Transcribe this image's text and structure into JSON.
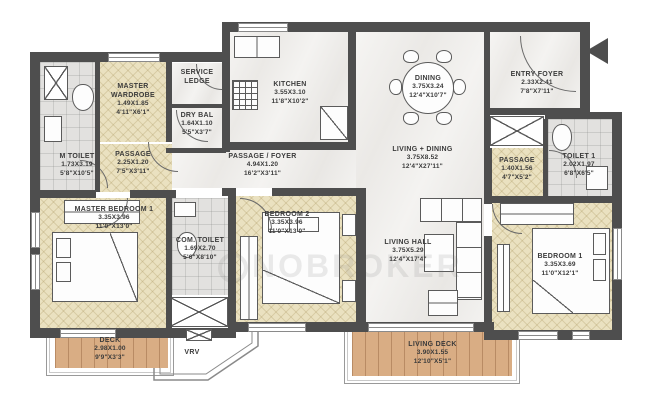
{
  "watermark": "NOBROKER",
  "colors": {
    "wall": "#4e4e4e",
    "bedroom_floor": "#eae1c0",
    "marble_floor": "#f2f1ef",
    "deck_floor": "#d9ad84",
    "toilet_floor": "#e2e1df",
    "label_text": "#3b3b3b"
  },
  "rooms": [
    {
      "name": "MASTER WARDROBE",
      "m": "1.49X1.85",
      "ft": "4'11\"X6'1\""
    },
    {
      "name": "SERVICE LEDGE",
      "m": "",
      "ft": ""
    },
    {
      "name": "DRY BAL",
      "m": "1.64X1.10",
      "ft": "5'5\"X3'7\""
    },
    {
      "name": "M TOILET",
      "m": "1.73X3.19",
      "ft": "5'8\"X10'5\""
    },
    {
      "name": "PASSAGE",
      "m": "2.25X1.20",
      "ft": "7'5\"X3'11\""
    },
    {
      "name": "KITCHEN",
      "m": "3.55X3.10",
      "ft": "11'8\"X10'2\""
    },
    {
      "name": "DINING",
      "m": "3.75X3.24",
      "ft": "12'4\"X10'7\""
    },
    {
      "name": "ENTRY FOYER",
      "m": "2.33X2.41",
      "ft": "7'8\"X7'11\""
    },
    {
      "name": "PASSAGE / FOYER",
      "m": "4.94X1.20",
      "ft": "16'2\"X3'11\""
    },
    {
      "name": "LIVING + DINING",
      "m": "3.75X8.52",
      "ft": "12'4\"X27'11\""
    },
    {
      "name": "PASSAGE",
      "m": "1.40X1.56",
      "ft": "4'7\"X5'2\""
    },
    {
      "name": "TOILET 1",
      "m": "2.02X1.97",
      "ft": "6'8\"X6'5\""
    },
    {
      "name": "MASTER BEDROOM 1",
      "m": "3.35X3.96",
      "ft": "11'0\"X13'0\""
    },
    {
      "name": "COM. TOILET",
      "m": "1.69X2.70",
      "ft": "5'6\"X8'10\""
    },
    {
      "name": "BEDROOM 2",
      "m": "3.35X3.96",
      "ft": "11'0\"X13'0\""
    },
    {
      "name": "LIVING HALL",
      "m": "3.75X5.29",
      "ft": "12'4\"X17'4\""
    },
    {
      "name": "BEDROOM 1",
      "m": "3.35X3.69",
      "ft": "11'0\"X12'1\""
    },
    {
      "name": "DECK",
      "m": "2.98X1.00",
      "ft": "9'9\"X3'3\""
    },
    {
      "name": "VRV",
      "m": "",
      "ft": ""
    },
    {
      "name": "LIVING DECK",
      "m": "3.90X1.55",
      "ft": "12'10\"X5'1\""
    }
  ]
}
